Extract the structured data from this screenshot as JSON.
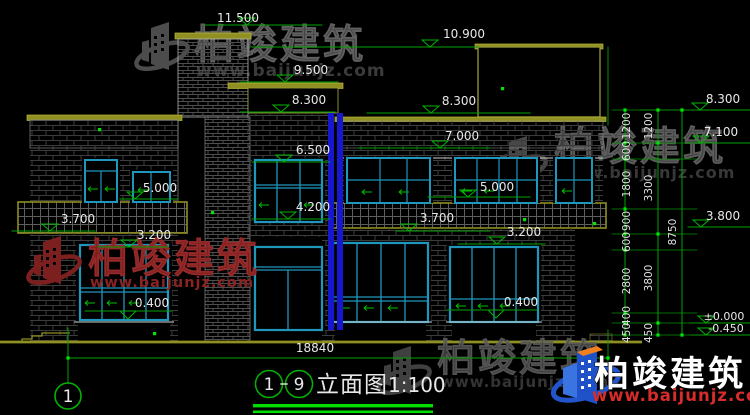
{
  "watermarks": {
    "brand": "柏竣建筑",
    "url": "www.baijunjz.com"
  },
  "labels": {
    "e11500": "11.500",
    "e10900": "10.900",
    "e9500": "9.500",
    "e8300_mid": "8.300",
    "e8300_right": "8.300",
    "e7000": "7.000",
    "e6500": "6.500",
    "e5000_left": "5.000",
    "e5000_right": "5.000",
    "e4200": "4.200",
    "e3700_left": "3.700",
    "e3700_right": "3.700",
    "e3200_left": "3.200",
    "e3200_right": "3.200",
    "e0400_left": "0.400",
    "e0400_right": "0.400"
  },
  "side_labels": {
    "e8300": "8.300",
    "e7100": "7.100",
    "e3800": "3.800",
    "e0000": "±0.000",
    "em0450": "-0.450"
  },
  "chains": {
    "inner": [
      "1200",
      "600",
      "1800",
      "900",
      "600",
      "2800",
      "400",
      "450"
    ],
    "middle": [
      "1200",
      "3300",
      "3800",
      "450"
    ],
    "total": "8750"
  },
  "bottom": {
    "total_width": "18840"
  },
  "title": {
    "axis_start": "1",
    "axis_end": "9",
    "name": "立面图",
    "scale": "1:100",
    "axis_bubble": "1"
  },
  "colors": {
    "line_green": "#00a200",
    "bright_green": "#00dd00",
    "olive": "#8f8f22",
    "window_cyan": "#1f97bd",
    "column_blue": "#1717cf",
    "watermark_red": "#8a2020",
    "brand_red_url": "#d62c2c"
  }
}
